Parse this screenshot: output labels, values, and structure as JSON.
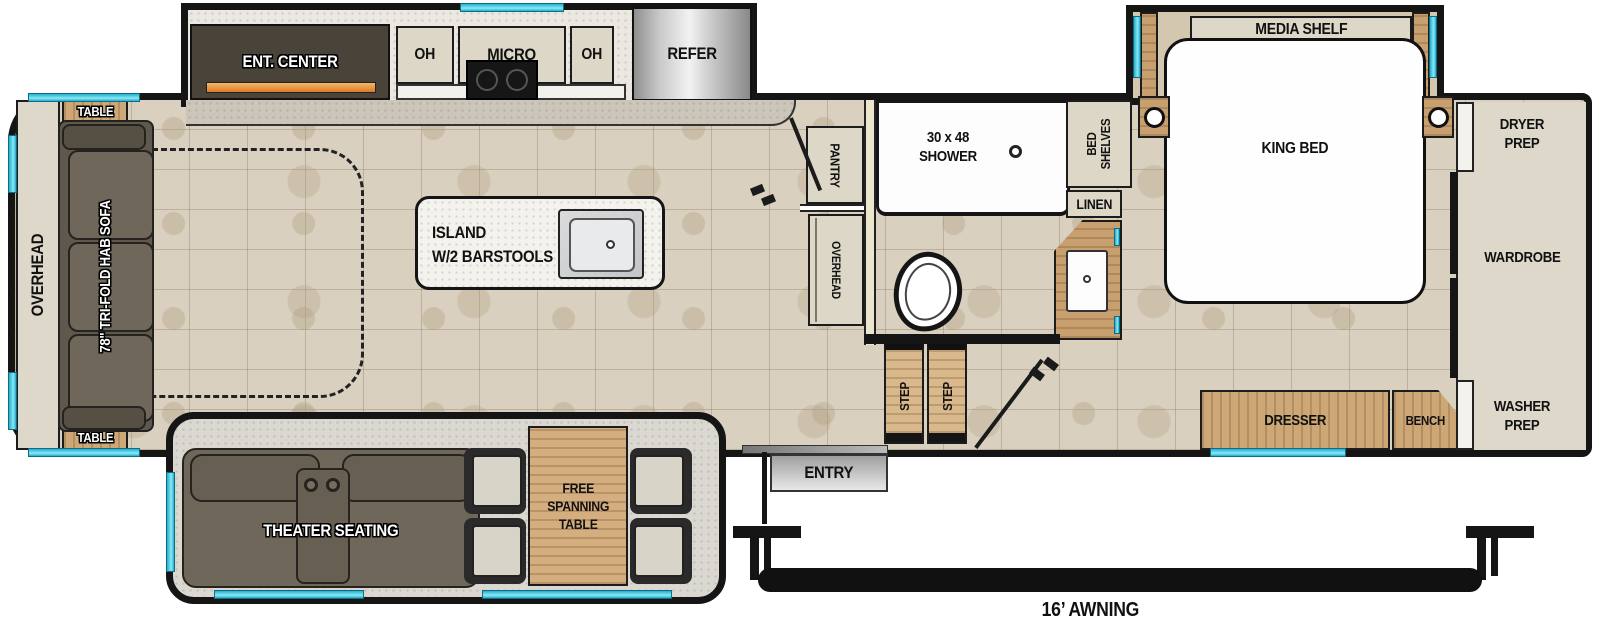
{
  "meta": {
    "type": "rv-fifth-wheel-floorplan"
  },
  "colors": {
    "wall": "#151515",
    "floor_tile": "#d9d0bf",
    "cabinet": "#dcd7c6",
    "wood": "#c89f6e",
    "dark_furniture": "#6e675a",
    "window_accent": "#35c3de",
    "fireplace_accent": "#e8923f",
    "refrigerator_steel": "#c8c8c8",
    "white_fixture": "#fdfdfd"
  },
  "rear": {
    "overhead": "OVERHEAD",
    "table_top": "TABLE",
    "table_bottom": "TABLE",
    "sofa": "78\" TRI-FOLD HAB SOFA"
  },
  "kitchen": {
    "ent_center": "ENT. CENTER",
    "oh_left": "OH",
    "micro": "MICRO",
    "oh_right": "OH",
    "refer": "REFER",
    "island_line1": "ISLAND",
    "island_line2": "W/2 BARSTOOLS"
  },
  "living": {
    "theater": "THEATER SEATING",
    "table_line1": "FREE",
    "table_line2": "SPANNING",
    "table_line3": "TABLE"
  },
  "bath": {
    "pantry": "PANTRY",
    "overhead": "OVERHEAD",
    "shower_line1": "30 x 48",
    "shower_line2": "SHOWER",
    "linen": "LINEN",
    "step_left": "STEP",
    "step_right": "STEP"
  },
  "bedroom": {
    "media_shelf": "MEDIA SHELF",
    "king_bed": "KING BED",
    "bed_shelves_line1": "BED",
    "bed_shelves_line2": "SHELVES",
    "dresser": "DRESSER",
    "bench": "BENCH"
  },
  "front_closet": {
    "dryer_line1": "DRYER",
    "dryer_line2": "PREP",
    "wardrobe": "WARDROBE",
    "washer_line1": "WASHER",
    "washer_line2": "PREP"
  },
  "exterior": {
    "entry": "ENTRY",
    "awning": "16’ AWNING"
  }
}
